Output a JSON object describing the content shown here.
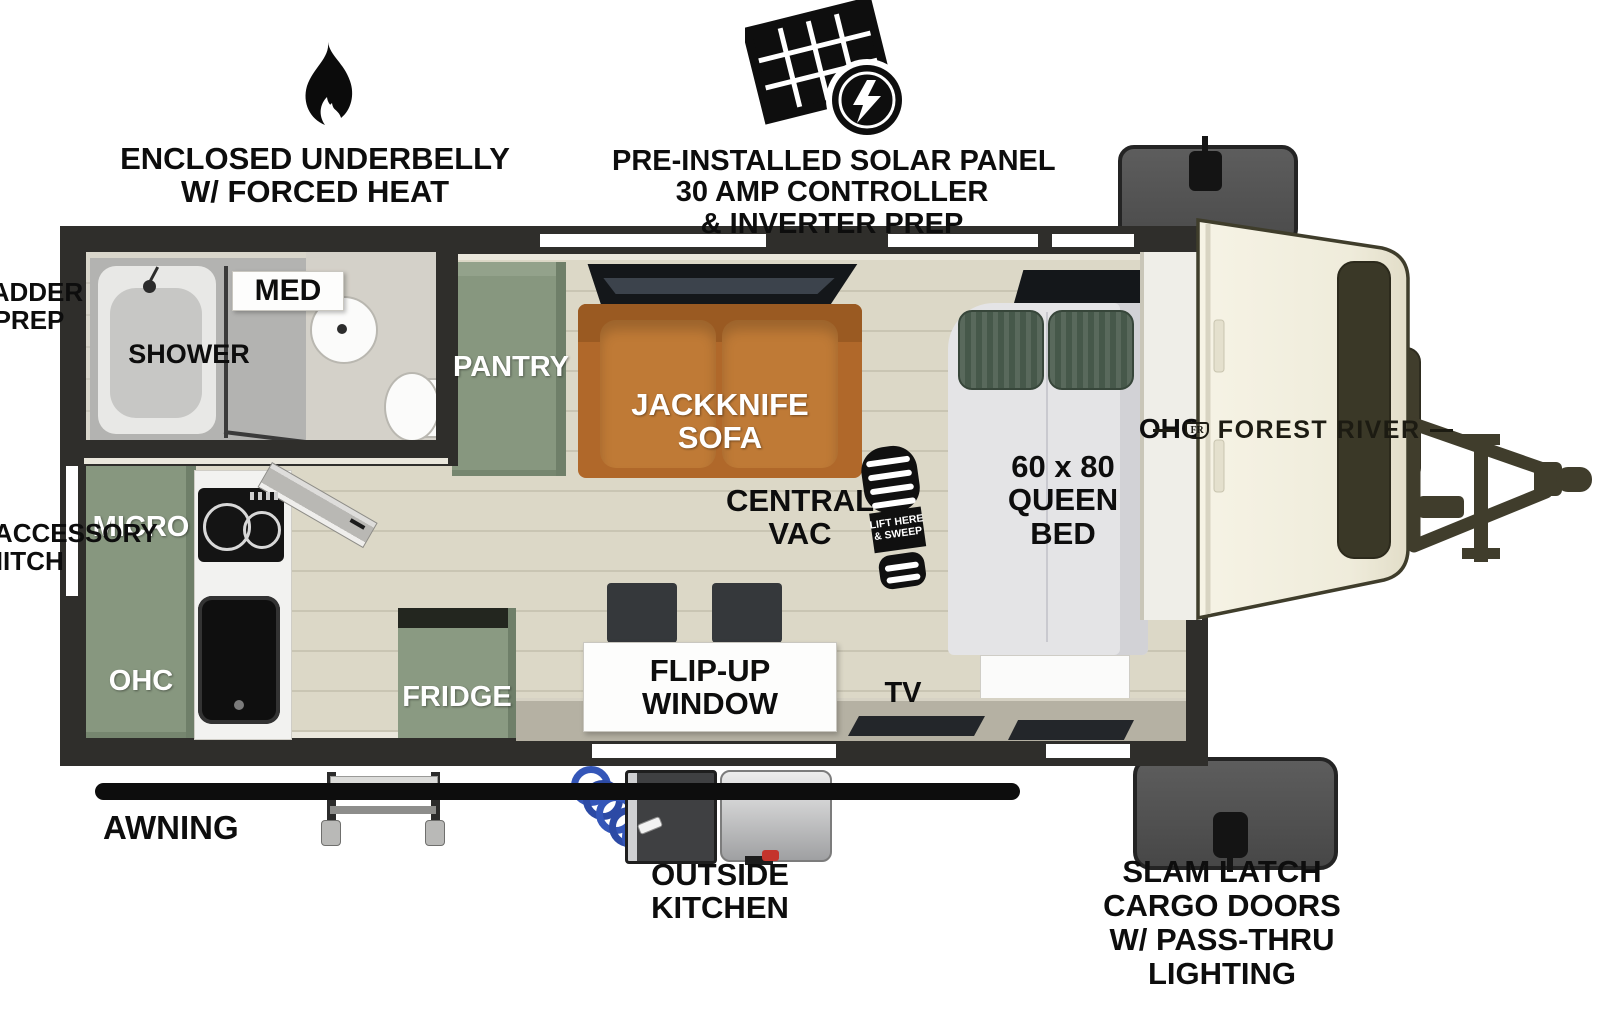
{
  "colors": {
    "wall_dark": "#2f2e2b",
    "floor_beige": "#dcd8c7",
    "cabinet_green": "#87977f",
    "sofa_orange": "#b0682a",
    "pillow_green": "#46584a",
    "front_cap_cream": "#f2efe0",
    "cap_window_olive": "#3a3827",
    "cargo_door_gray": "#565656",
    "hose_blue": "#3456b8"
  },
  "callouts": {
    "underbelly": {
      "line1": "ENCLOSED UNDERBELLY",
      "line2": "W/ FORCED HEAT"
    },
    "solar": {
      "line1": "PRE-INSTALLED SOLAR PANEL",
      "line2": "30 AMP CONTROLLER",
      "line3": "& INVERTER PREP"
    },
    "ladder_prep": {
      "line1": "LADDER",
      "line2": "PREP"
    },
    "rear_hitch": {
      "line1": "REAR ACCESSORY",
      "line2": "HITCH"
    },
    "awning": "AWNING",
    "outside_kitchen": {
      "line1": "OUTSIDE",
      "line2": "KITCHEN"
    },
    "cargo_doors": {
      "line1": "SLAM LATCH",
      "line2": "CARGO DOORS",
      "line3": "W/ PASS-THRU",
      "line4": "LIGHTING"
    }
  },
  "interior": {
    "shower": "SHOWER",
    "med": "MED",
    "pantry": "PANTRY",
    "sofa": {
      "line1": "JACKKNIFE",
      "line2": "SOFA"
    },
    "central_vac": {
      "line1": "CENTRAL",
      "line2": "VAC"
    },
    "vac_boot": {
      "line1": "LIFT HERE",
      "line2": "& SWEEP"
    },
    "bed": {
      "line1": "60 x 80",
      "line2": "QUEEN",
      "line3": "BED"
    },
    "ohc_front": "OHC",
    "micro": "MICRO",
    "ohc_rear": "OHC",
    "fridge": "FRIDGE",
    "flip_window": {
      "line1": "FLIP-UP",
      "line2": "WINDOW"
    },
    "tv": "TV"
  },
  "brand": {
    "crest": "FR",
    "name": "FOREST RIVER"
  }
}
